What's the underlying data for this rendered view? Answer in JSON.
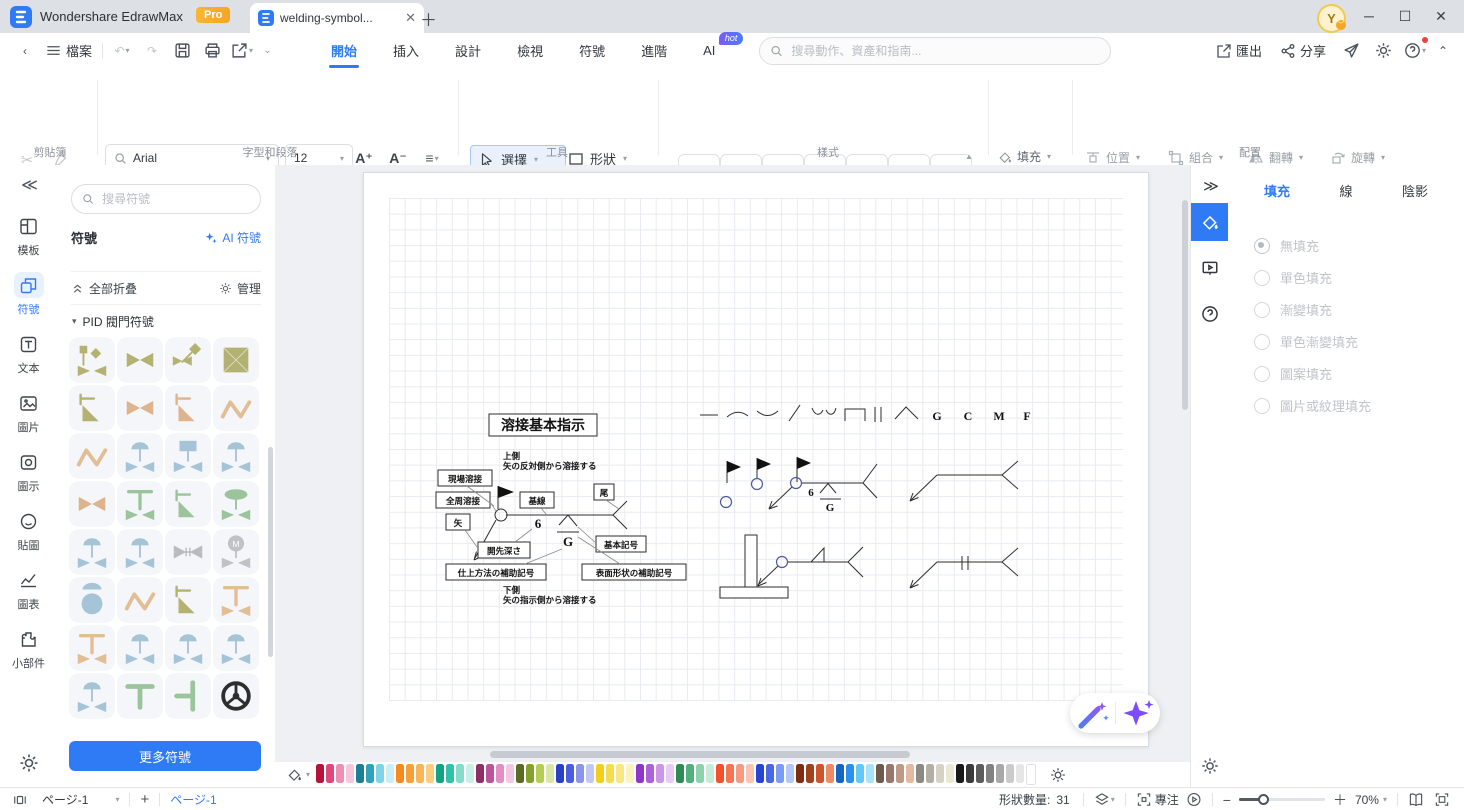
{
  "titlebar": {
    "app_name": "Wondershare EdrawMax",
    "pro_badge": "Pro",
    "doc_tab_title": "welding-symbol...",
    "avatar_initial": "Y"
  },
  "menubar": {
    "file_label": "檔案",
    "tabs": [
      {
        "label": "開始",
        "active": true
      },
      {
        "label": "插入"
      },
      {
        "label": "設計"
      },
      {
        "label": "檢視"
      },
      {
        "label": "符號"
      },
      {
        "label": "進階"
      },
      {
        "label": "AI",
        "badge": "hot"
      }
    ],
    "search_placeholder": "搜尋動作、資產和指南...",
    "export_label": "匯出",
    "share_label": "分享"
  },
  "ribbon": {
    "clipboard": {
      "label": "剪貼簿"
    },
    "font": {
      "family": "Arial",
      "size": "12",
      "increase": "A⁺",
      "decrease": "A⁻",
      "buttons": [
        "B",
        "I",
        "U",
        "S",
        "X²",
        "X₂",
        "T",
        "↕≡",
        "≡",
        "ab",
        "A"
      ],
      "label": "字型和段落"
    },
    "tools": {
      "select": "選擇",
      "shape": "形狀",
      "text": "文本",
      "connector": "連接線",
      "label": "工具"
    },
    "styles": {
      "items": [
        "Abc",
        "Abc",
        "Abc",
        "Abc",
        "Abc",
        "Abc",
        "Abc"
      ],
      "label": "樣式"
    },
    "style_mini": {
      "fill": "填充",
      "line": "線",
      "shadow": "陰影"
    },
    "arrange": {
      "position": "位置",
      "group": "組合",
      "flip": "翻轉",
      "rotate": "旋轉",
      "align": "對齊",
      "size": "大小",
      "lock": "鎖定",
      "replace": "替換形狀",
      "label": "配置"
    }
  },
  "left_rail": {
    "items": [
      {
        "icon": "template",
        "label": "模板"
      },
      {
        "icon": "symbol",
        "label": "符號",
        "active": true
      },
      {
        "icon": "text",
        "label": "文本"
      },
      {
        "icon": "image",
        "label": "圖片"
      },
      {
        "icon": "iconlib",
        "label": "圖示"
      },
      {
        "icon": "sticker",
        "label": "貼圖"
      },
      {
        "icon": "chart",
        "label": "圖表"
      },
      {
        "icon": "widget",
        "label": "小部件"
      }
    ]
  },
  "symbol_panel": {
    "search_placeholder": "搜尋符號",
    "header": "符號",
    "ai_symbols": "AI 符號",
    "collapse_all": "全部折叠",
    "manage": "管理",
    "category": "PID 閥門符號",
    "more_button": "更多符號",
    "tiles": [
      {
        "name": "pid-valve-actuator",
        "color": "#b4b273",
        "glyph": "actuator"
      },
      {
        "name": "pid-valve-gate",
        "color": "#b4b273",
        "glyph": "bowtie"
      },
      {
        "name": "pid-valve-diamond",
        "color": "#b4b273",
        "glyph": "diamond"
      },
      {
        "name": "pid-valve-box",
        "color": "#b4b273",
        "glyph": "boxx"
      },
      {
        "name": "pid-valve-angle",
        "color": "#b4b273",
        "glyph": "angle"
      },
      {
        "name": "pid-valve-gate-2",
        "color": "#ddb48e",
        "glyph": "bowtie"
      },
      {
        "name": "pid-valve-tilt",
        "color": "#ddb48e",
        "glyph": "angle"
      },
      {
        "name": "pid-pipe-zigzag",
        "color": "#e2bd96",
        "glyph": "zigzag"
      },
      {
        "name": "pid-pipe-zigzag-2",
        "color": "#e2bd96",
        "glyph": "zigzag"
      },
      {
        "name": "pid-valve-diaphragm",
        "color": "#a6c4d8",
        "glyph": "dome"
      },
      {
        "name": "pid-valve-piston",
        "color": "#a6c4d8",
        "glyph": "box"
      },
      {
        "name": "pid-valve-relief",
        "color": "#a6c4d8",
        "glyph": "dome"
      },
      {
        "name": "pid-valve-gate-3",
        "color": "#ddb48e",
        "glyph": "bowtie"
      },
      {
        "name": "pid-valve-tee",
        "color": "#9cc49c",
        "glyph": "tee"
      },
      {
        "name": "pid-valve-angle-2",
        "color": "#9cc49c",
        "glyph": "angle"
      },
      {
        "name": "pid-valve-mushroom",
        "color": "#9cc49c",
        "glyph": "mushroom"
      },
      {
        "name": "pid-valve-diaphragm-2",
        "color": "#a6c4d8",
        "glyph": "dome"
      },
      {
        "name": "pid-valve-diaphragm-3",
        "color": "#a6c4d8",
        "glyph": "dome"
      },
      {
        "name": "pid-valve-check",
        "color": "#b9bcbf",
        "glyph": "hvalve"
      },
      {
        "name": "pid-valve-motor",
        "color": "#c0c3c6",
        "glyph": "motor",
        "letter": "M"
      },
      {
        "name": "pid-valve-ball",
        "color": "#a6c4d8",
        "glyph": "ball"
      },
      {
        "name": "pid-pipe-zigzag-3",
        "color": "#e2bd96",
        "glyph": "zigzag"
      },
      {
        "name": "pid-valve-needle",
        "color": "#b4b273",
        "glyph": "angle"
      },
      {
        "name": "pid-valve-tee-2",
        "color": "#e2bd96",
        "glyph": "tee"
      },
      {
        "name": "pid-valve-tee-3",
        "color": "#e2bd96",
        "glyph": "tee"
      },
      {
        "name": "pid-valve-diaphragm-4",
        "color": "#a6c4d8",
        "glyph": "dome"
      },
      {
        "name": "pid-valve-diaphragm-5",
        "color": "#a6c4d8",
        "glyph": "dome"
      },
      {
        "name": "pid-valve-diaphragm-6",
        "color": "#a6c4d8",
        "glyph": "dome"
      },
      {
        "name": "pid-valve-diaphragm-7",
        "color": "#a6c4d8",
        "glyph": "dome"
      },
      {
        "name": "pid-fitting-tee",
        "color": "#9cc49c",
        "glyph": "teebar"
      },
      {
        "name": "pid-fitting-tee-right",
        "color": "#9cc49c",
        "glyph": "teeright"
      },
      {
        "name": "pid-handwheel",
        "color": "#2e2e2e",
        "glyph": "wheel"
      }
    ]
  },
  "canvas": {
    "diagram_title": "溶接基本指示",
    "notes": {
      "top1": "上側",
      "top2": "矢の反対側から溶接する",
      "bottom1": "下側",
      "bottom2": "矢の指示側から溶接する"
    },
    "labels": {
      "site_weld": "現場溶接",
      "all_around_weld": "全周溶接",
      "arrow": "矢",
      "base_line": "基線",
      "tail": "尾",
      "basic_symbol": "基本記号",
      "groove_depth": "開先深さ",
      "finish_aux": "仕上方法の補助記号",
      "surface_aux": "表面形状の補助記号"
    },
    "values": {
      "depth": "6",
      "finish": "G",
      "depth2": "6",
      "finish2": "G"
    },
    "letters": {
      "g": "G",
      "c": "C",
      "m": "M",
      "f": "F"
    }
  },
  "right_panel": {
    "tabs": [
      {
        "label": "填充",
        "active": true
      },
      {
        "label": "線"
      },
      {
        "label": "陰影"
      }
    ],
    "options": [
      {
        "label": "無填充",
        "selected": true
      },
      {
        "label": "單色填充"
      },
      {
        "label": "漸變填充"
      },
      {
        "label": "單色漸變填充"
      },
      {
        "label": "圖案填充"
      },
      {
        "label": "圖片或紋理填充"
      }
    ]
  },
  "palette": {
    "colors": [
      "#b5123c",
      "#e0487b",
      "#f08fb4",
      "#f7c6da",
      "#1c7f95",
      "#2fa3bb",
      "#7fd4e8",
      "#c9eef7",
      "#f58b1f",
      "#f6a03a",
      "#f9b659",
      "#fbcd80",
      "#12a385",
      "#2fc3a7",
      "#85ddc9",
      "#c9f0e6",
      "#8e2f68",
      "#bb549a",
      "#e38fc6",
      "#f4c6e3",
      "#5d6b22",
      "#87a12f",
      "#b5cc55",
      "#d9e7a6",
      "#2742c7",
      "#4b5ee0",
      "#8a96ec",
      "#c2c8f6",
      "#f2cf1f",
      "#f5dd50",
      "#f8e885",
      "#fbf3bd",
      "#8f35c9",
      "#ac61da",
      "#cd95ea",
      "#e8caf7",
      "#2e8b57",
      "#51b07c",
      "#8cd2ab",
      "#c6ebd7",
      "#f4502a",
      "#f67452",
      "#f99a80",
      "#fbc3b2",
      "#2744d4",
      "#4a67e8",
      "#7c9bf3",
      "#b3c7fa",
      "#7c2d12",
      "#a0421c",
      "#d0542a",
      "#ef8a64",
      "#1565c0",
      "#2b8ff0",
      "#63c7f8",
      "#a5e2fb",
      "#6d5a4e",
      "#97786a",
      "#bd9a85",
      "#e3b9a2",
      "#8c8a82",
      "#b3afa5",
      "#d6d1c4",
      "#ece6d5",
      "#191919",
      "#3a3a3a",
      "#5c5c5c",
      "#828282",
      "#a8a8a8",
      "#cbcbcb",
      "#e6e6e6",
      "#ffffff"
    ]
  },
  "statusbar": {
    "page_select": "ページ-1",
    "add_page": "+",
    "page_tab": "ページ-1",
    "shape_count_label": "形狀數量:",
    "shape_count": "31",
    "focus_label": "專注",
    "zoom_value": "70%"
  }
}
